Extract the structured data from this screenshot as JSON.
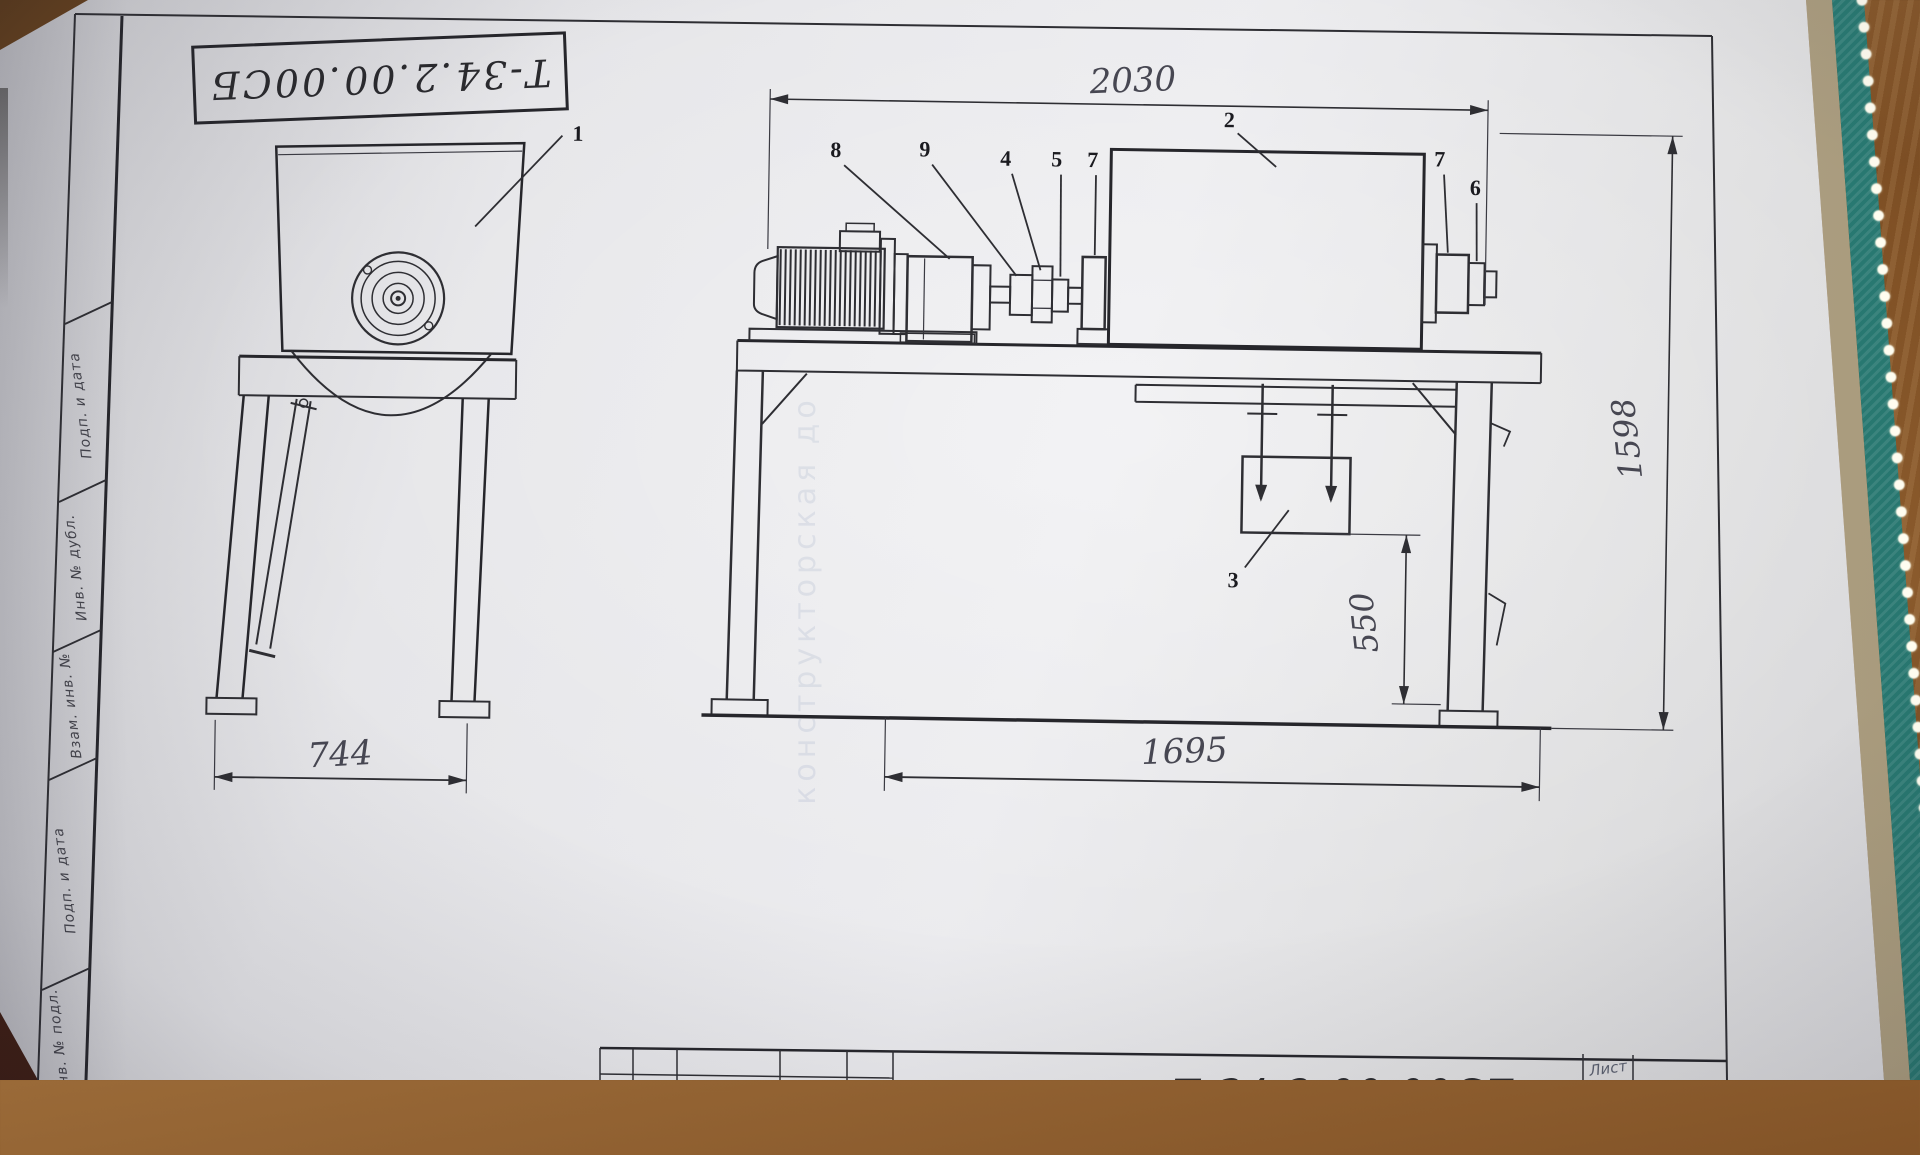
{
  "drawing": {
    "code_stamp_top": "Т-34.2.00.00СБ",
    "code_stamp_bottom": "Т-34.2.00.00СБ",
    "sheet_cell": "Лист",
    "watermark": "конструкторская до",
    "sidebar": {
      "labels": [
        "Подп. и дата",
        "Инв. № дубл.",
        "Взам. инв. №",
        "Подп. и дата",
        "Инв. № подл."
      ]
    },
    "dimensions": {
      "front_width": "744",
      "overall_length": "2030",
      "frame_length": "1695",
      "discharge_height": "550",
      "overall_height": "1598"
    },
    "callouts": {
      "n1": "1",
      "n2": "2",
      "n3": "3",
      "n4": "4",
      "n5": "5",
      "n6": "6",
      "n7": "7",
      "n7b": "7",
      "n8": "8",
      "n9": "9"
    },
    "colors": {
      "paper": "#e6e6e9",
      "ink": "#2e2e33",
      "pencil": "#474752",
      "wood": "#7a4a22",
      "book_edge": "#2f8f86"
    }
  }
}
